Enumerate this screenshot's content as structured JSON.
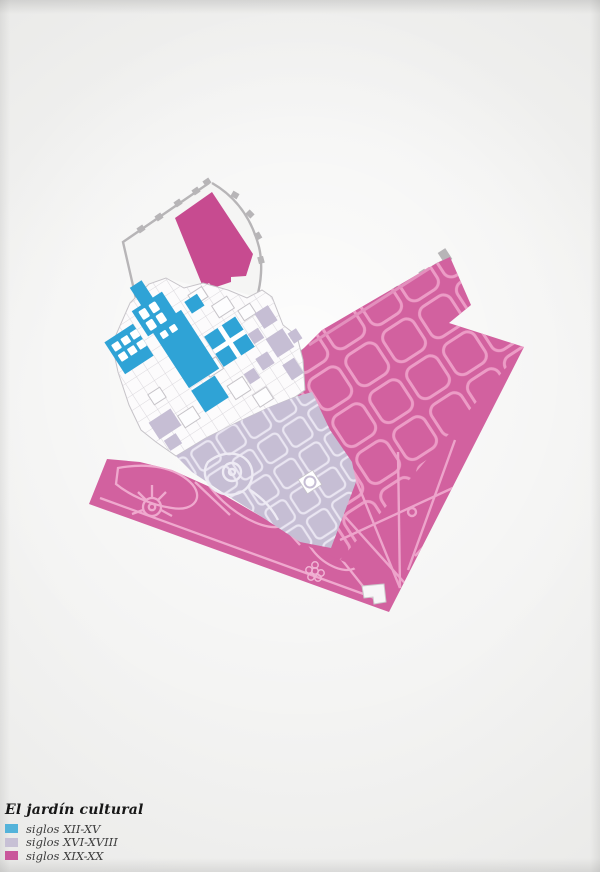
{
  "legend": {
    "title": "El jardín cultural",
    "items": [
      {
        "label": "siglos XII-XV",
        "color": "#54b3da"
      },
      {
        "label": "siglos XVI-XVIII",
        "color": "#c7c0d5"
      },
      {
        "label": "siglos XIX-XX",
        "color": "#c9579b"
      }
    ]
  },
  "map_colors": {
    "siglos_xii_xv": "#2fa3d6",
    "siglos_xvi_xviii": "#c6bed4",
    "siglos_xix_xx": "#d2619f",
    "siglos_xix_xx_dark": "#c74b90",
    "paths_on_pink": "#efa9ce",
    "paths_on_lavender": "#eae6f2",
    "walls": "#b7b5b7",
    "buildings": "#fcfbfc",
    "paper": "#ececea"
  }
}
